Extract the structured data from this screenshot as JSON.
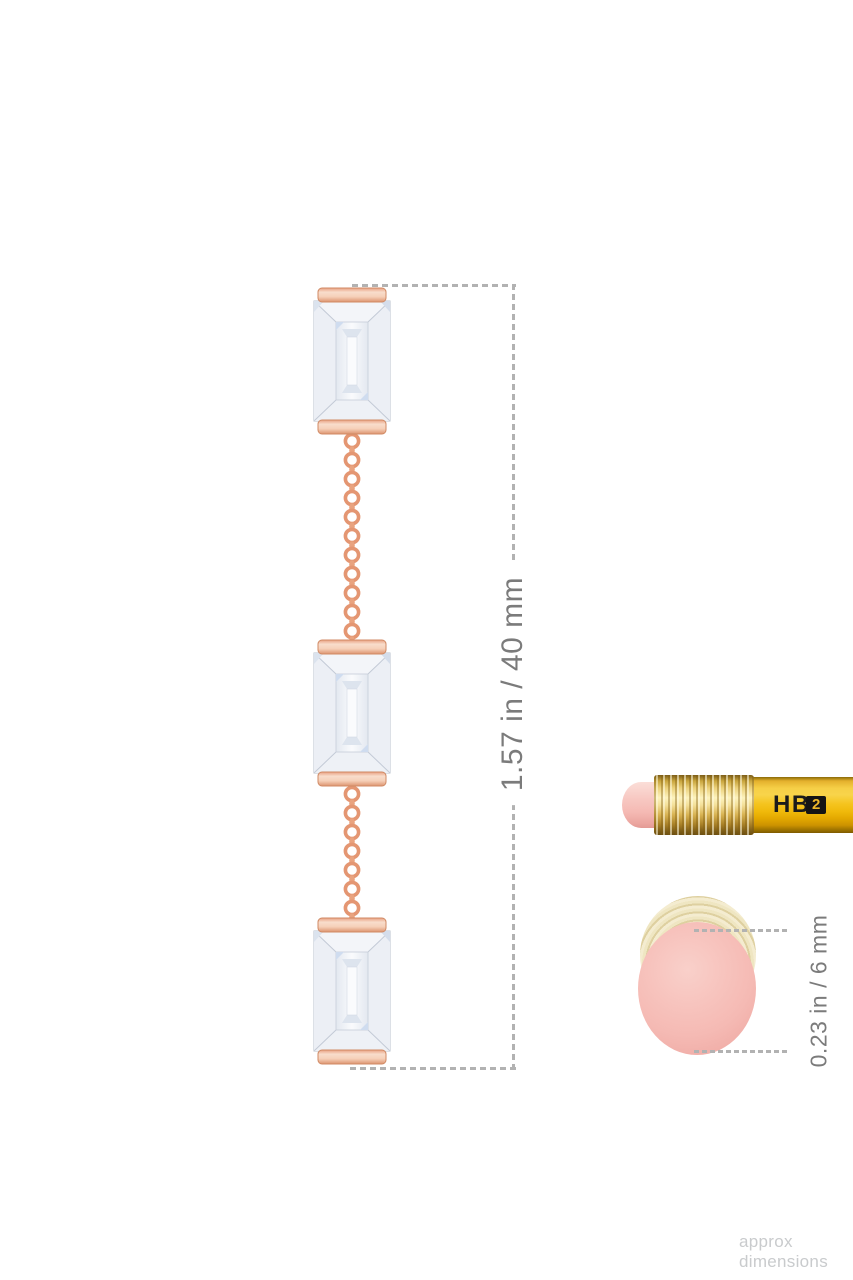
{
  "measurements": {
    "earring_drop": "1.57 in / 40 mm",
    "eraser_diameter": "0.23 in / 6 mm"
  },
  "pencil": {
    "grade": "HB",
    "number": "2"
  },
  "footer": {
    "note": "approx dimensions"
  },
  "colors": {
    "rose_gold": "#e49672",
    "rose_gold_light": "#f8ddcb",
    "diamond_white": "#f5f7fa",
    "diamond_facet": "#c3cad6",
    "dimension_line": "#b2b2b2",
    "dimension_text": "#7b7b7b",
    "pencil_yellow": "#f5c41e",
    "ferrule_gold": "#e8cf7c",
    "eraser_pink": "#f5bab4",
    "ferrule_cream": "#ece0b8",
    "pencil_text": "#1b1b1b",
    "pencil_badge_bg": "#141414",
    "pencil_badge_text": "#edb82a",
    "footer_text": "#c9cbcd"
  }
}
